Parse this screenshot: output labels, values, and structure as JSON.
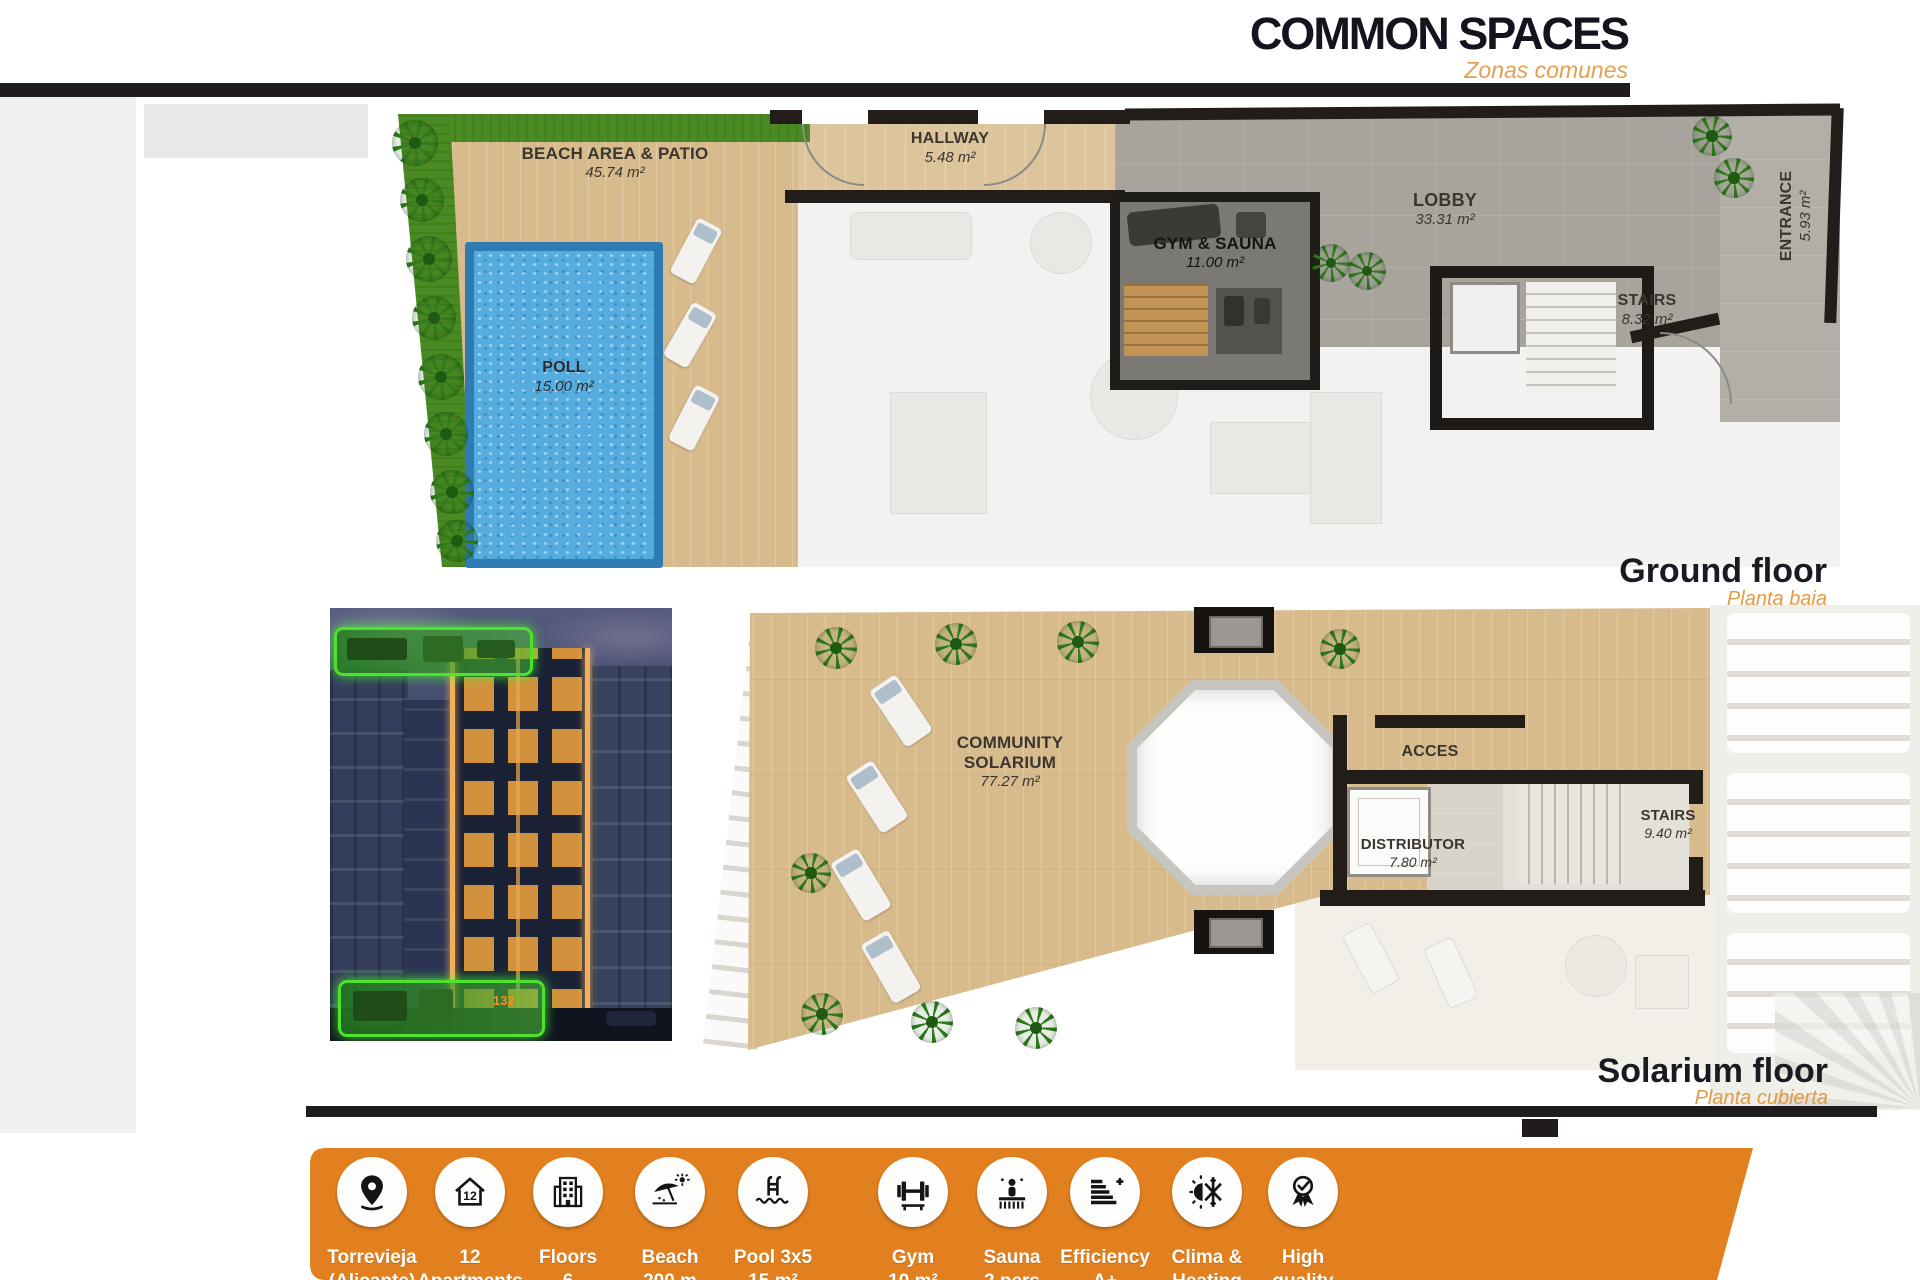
{
  "header": {
    "title": "COMMON SPACES",
    "subtitle": "Zonas comunes"
  },
  "ground_floor": {
    "caption": "Ground floor",
    "subcaption": "Planta baja",
    "beach": {
      "name": "BEACH AREA & PATIO",
      "area": "45.74 m²"
    },
    "hallway": {
      "name": "HALLWAY",
      "area": "5.48 m²"
    },
    "pool": {
      "name": "POLL",
      "area": "15.00 m²"
    },
    "gym": {
      "name": "GYM & SAUNA",
      "area": "11.00 m²"
    },
    "lobby": {
      "name": "LOBBY",
      "area": "33.31 m²"
    },
    "stairs": {
      "name": "STAIRS",
      "area": "8.32 m²"
    },
    "entrance": {
      "name": "ENTRANCE",
      "area": "5.93 m²"
    }
  },
  "solarium_floor": {
    "caption": "Solarium floor",
    "subcaption": "Planta cubierta",
    "community": {
      "name_line1": "COMMUNITY",
      "name_line2": "SOLARIUM",
      "area": "77.27 m²"
    },
    "acces": {
      "name": "ACCES"
    },
    "distributor": {
      "name": "DISTRIBUTOR",
      "area": "7.80 m²"
    },
    "stairs": {
      "name": "STAIRS",
      "area": "9.40 m²"
    }
  },
  "building_photo": {
    "unit_label": "132"
  },
  "features": [
    {
      "icon": "location-pin-icon",
      "line1": "Torrevieja",
      "line2": "(Alicante)"
    },
    {
      "icon": "house-count-icon",
      "line1": "12",
      "line2": "Apartments"
    },
    {
      "icon": "building-floors-icon",
      "line1": "Floors",
      "line2": "6"
    },
    {
      "icon": "beach-icon",
      "line1": "Beach",
      "line2": "200 m"
    },
    {
      "icon": "pool-icon",
      "line1": "Pool 3x5",
      "line2": "15 m²"
    },
    {
      "icon": "gym-icon",
      "line1": "Gym",
      "line2": "10 m²"
    },
    {
      "icon": "sauna-icon",
      "line1": "Sauna",
      "line2": "2 pers"
    },
    {
      "icon": "efficiency-icon",
      "line1": "Efficiency",
      "line2": "A+"
    },
    {
      "icon": "climate-icon",
      "line1": "Clima &",
      "line2": "Heating"
    },
    {
      "icon": "quality-award-icon",
      "line1": "High",
      "line2": "quality"
    }
  ],
  "colors": {
    "accent_orange": "#E2801F",
    "subtitle_orange": "#E2A050",
    "bar_black": "#201C1D",
    "highlight_green": "#4CE22E",
    "pool_blue": "#54ADDE",
    "deck_tan": "#D7BB8D"
  }
}
